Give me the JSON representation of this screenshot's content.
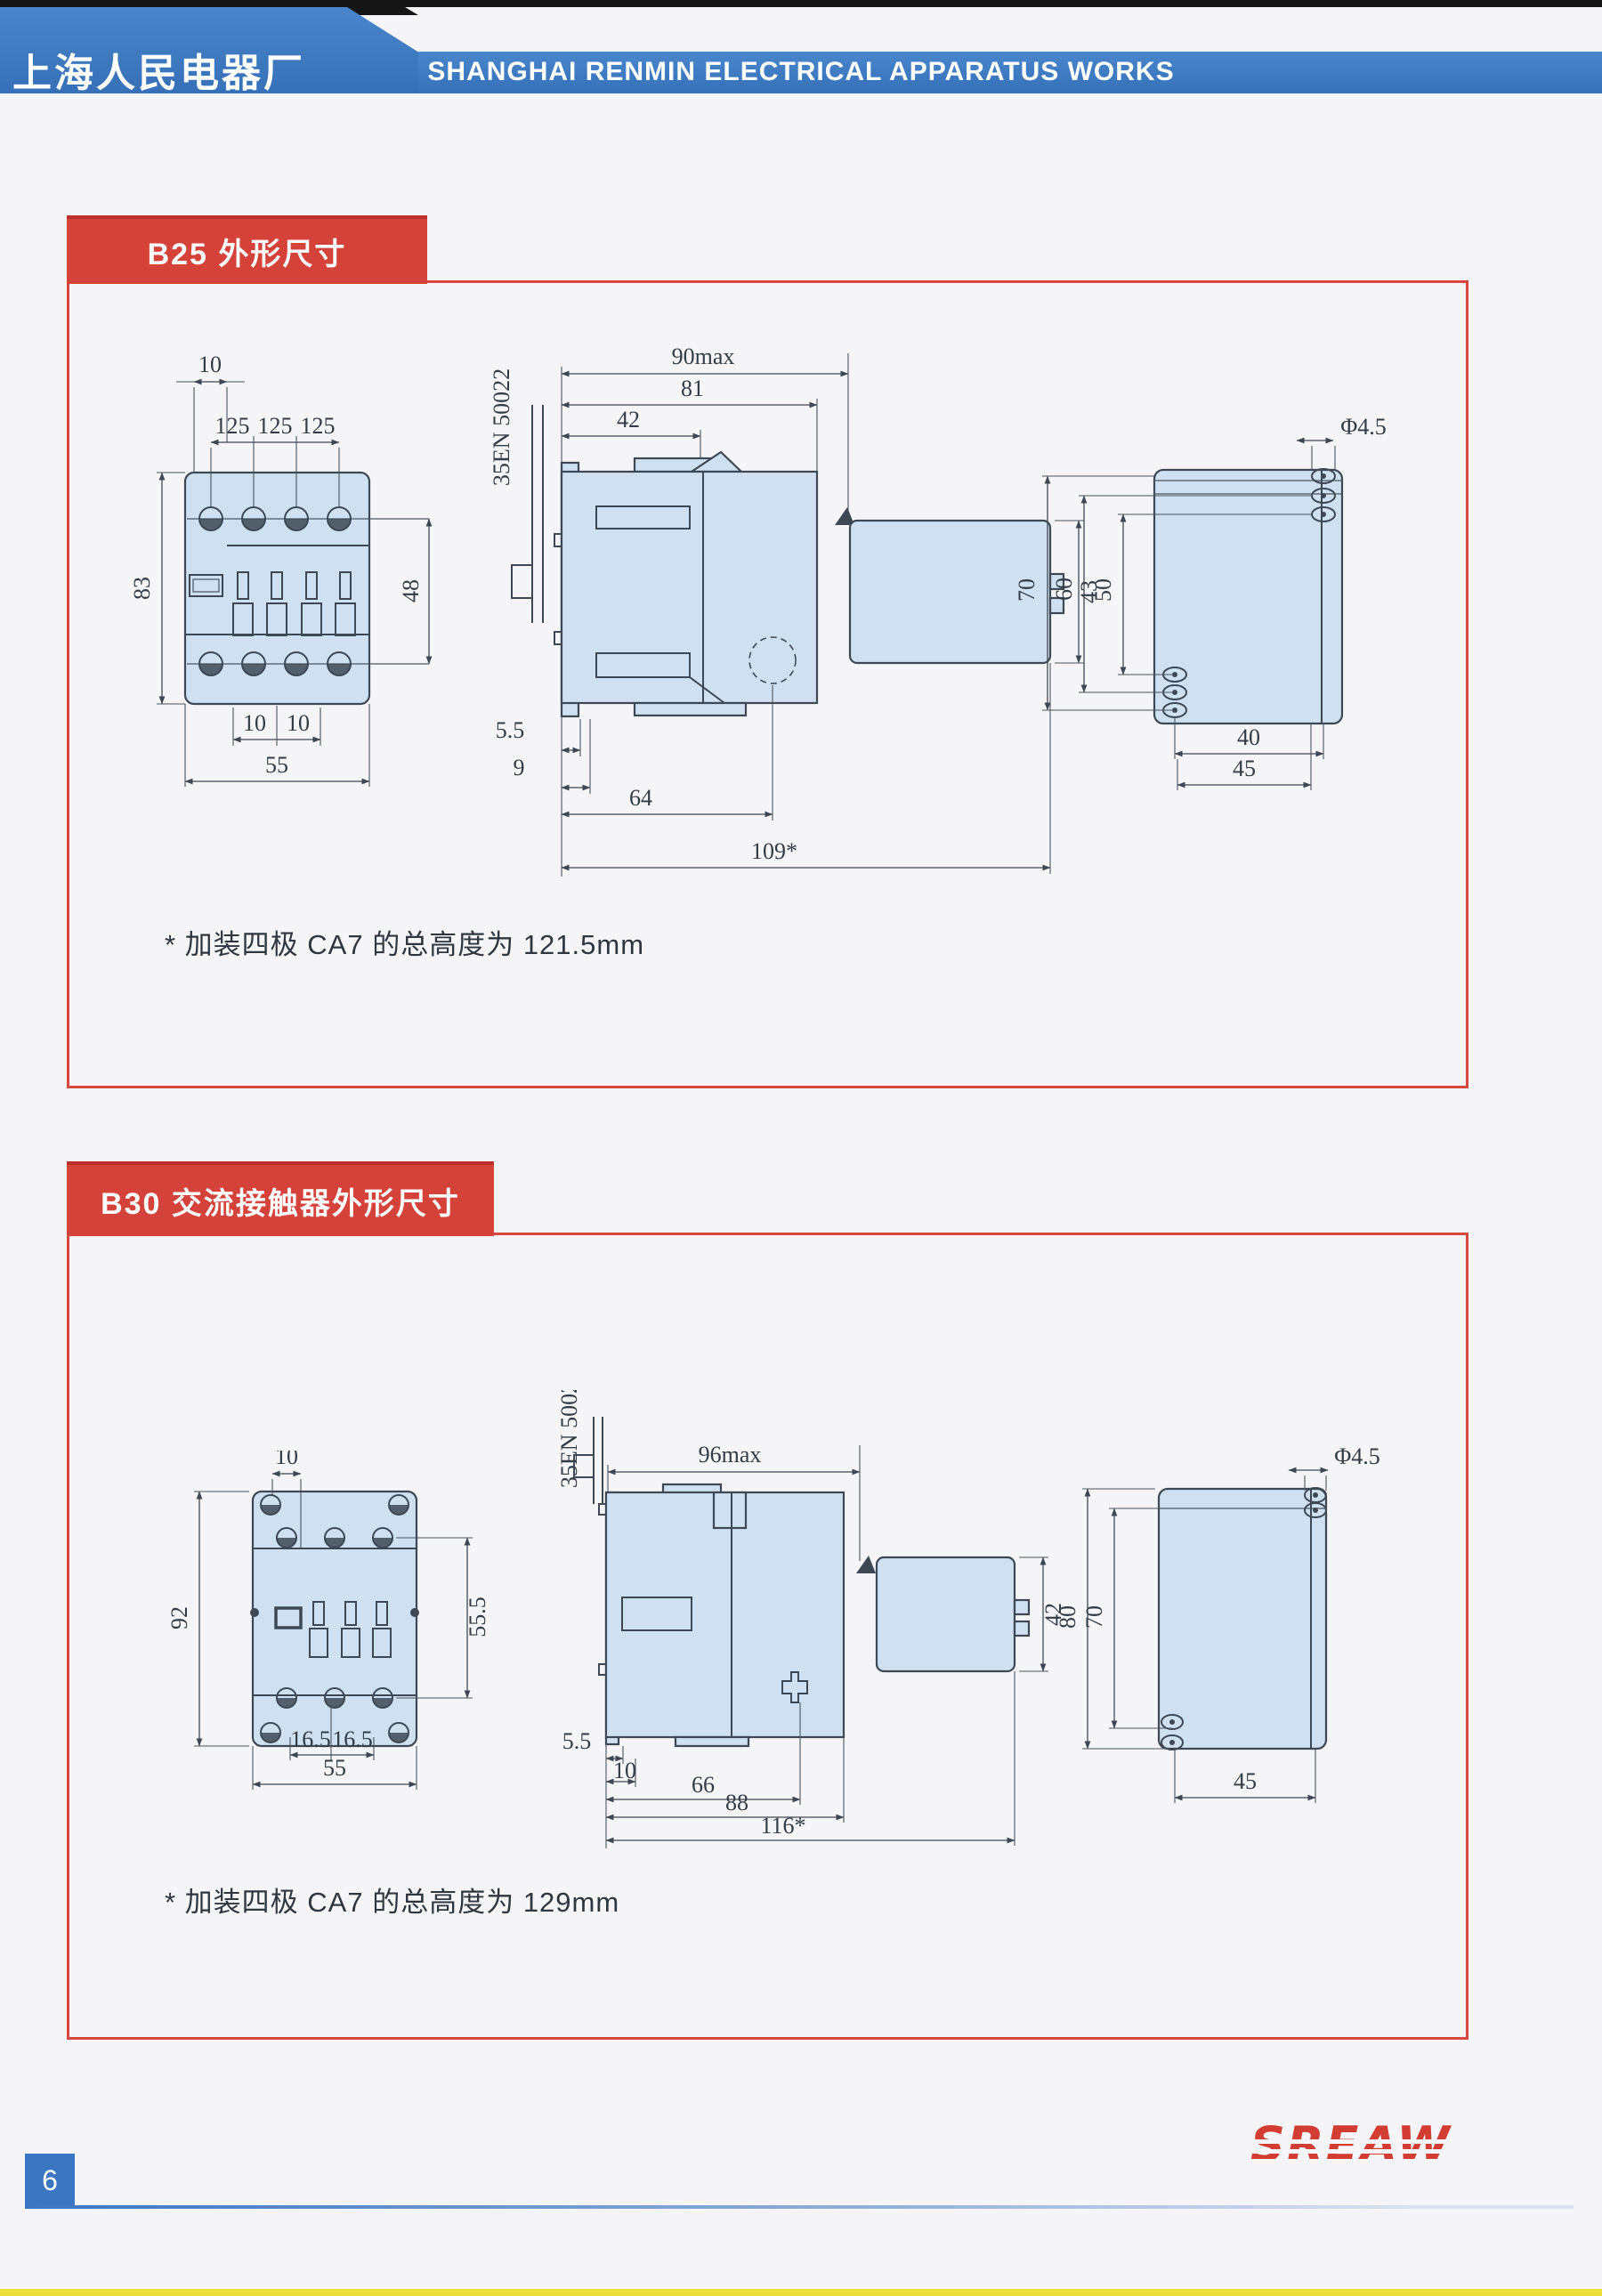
{
  "header": {
    "factory_zh": "上海人民电器厂",
    "factory_en": "SHANGHAI RENMIN ELECTRICAL APPARATUS WORKS"
  },
  "sections": {
    "b25": {
      "title": "B25 外形尺寸",
      "note": "* 加装四极 CA7 的总高度为 121.5mm",
      "front": {
        "d_top": "10",
        "p1": "125",
        "p2": "125",
        "p3": "125",
        "h": "83",
        "hc": "48",
        "b1": "10",
        "b2": "10",
        "w": "55"
      },
      "side": {
        "rail": "35EN 50022",
        "wmax": "90max",
        "w81": "81",
        "w42": "42",
        "h43": "43",
        "d55": "5.5",
        "d9": "9",
        "d64": "64",
        "total": "109*"
      },
      "rear": {
        "hole": "Φ4.5",
        "v70": "70",
        "v60": "60",
        "v50": "50",
        "h40": "40",
        "h45": "45"
      }
    },
    "b30": {
      "title": "B30 交流接触器外形尺寸",
      "note": "* 加装四极 CA7 的总高度为 129mm",
      "front": {
        "d_top": "10",
        "h": "92",
        "hc": "55.5",
        "b1": "16.5",
        "b2": "16.5",
        "w": "55"
      },
      "side": {
        "rail": "35EN 50022",
        "wmax": "96max",
        "h42": "42",
        "d55": "5.5",
        "d10": "10",
        "d66": "66",
        "d88": "88",
        "total": "116*"
      },
      "rear": {
        "hole": "Φ4.5",
        "v80": "80",
        "v70": "70",
        "h45": "45"
      }
    }
  },
  "footer": {
    "logo": "SREAW",
    "page": "6"
  },
  "colors": {
    "brand_blue": "#3b79c4",
    "section_red": "#d5423a",
    "drawing_fill": "#cfe0f1",
    "line": "#3d4854",
    "logo_red": "#d23c33"
  }
}
